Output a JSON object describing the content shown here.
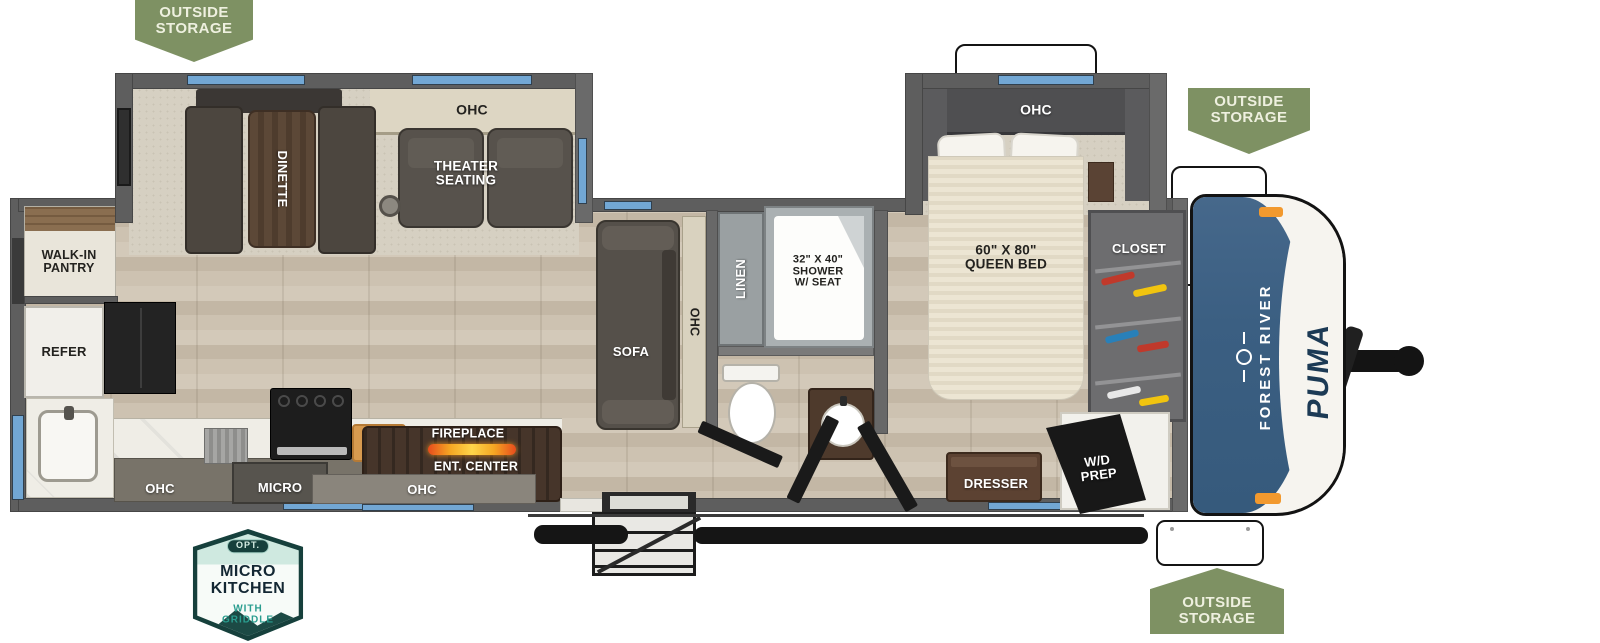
{
  "badges": {
    "outside_storage_top_left": {
      "text": "OUTSIDE\nSTORAGE"
    },
    "outside_storage_front": {
      "text": "OUTSIDE\nSTORAGE"
    },
    "outside_storage_bottom": {
      "text": "OUTSIDE\nSTORAGE"
    },
    "micro_kitchen": {
      "opt": "OPT.",
      "title": "MICRO\nKITCHEN",
      "subtitle": "WITH\nGRIDDLE"
    }
  },
  "branding": {
    "make": "FOREST RIVER",
    "model": "PUMA"
  },
  "labels": {
    "slide_ohc": "OHC",
    "dinette": "DINETTE",
    "theater_seating": "THEATER\nSEATING",
    "walk_in_pantry": "WALK-IN\nPANTRY",
    "refer": "REFER",
    "kitchen_ohc": "OHC",
    "micro": "MICRO",
    "galley_ohc": "OHC",
    "fireplace": "FIREPLACE",
    "ent_center": "ENT. CENTER",
    "sofa": "SOFA",
    "sofa_ohc": "OHC",
    "linen": "LINEN",
    "shower": "32\" X 40\"\nSHOWER\nW/ SEAT",
    "queen_bed": "60\" X 80\"\nQUEEN BED",
    "bedroom_ohc": "OHC",
    "closet": "CLOSET",
    "dresser": "DRESSER",
    "wd_prep": "W/D\nPREP"
  },
  "colors": {
    "badge_green": "#7E9163",
    "window_blue": "#72A7D4",
    "front_cap_blue": "#3E6181",
    "flame_orange": "#F39C12",
    "marker_orange": "#F2992E",
    "wall_gray": "#5E5E5E"
  }
}
